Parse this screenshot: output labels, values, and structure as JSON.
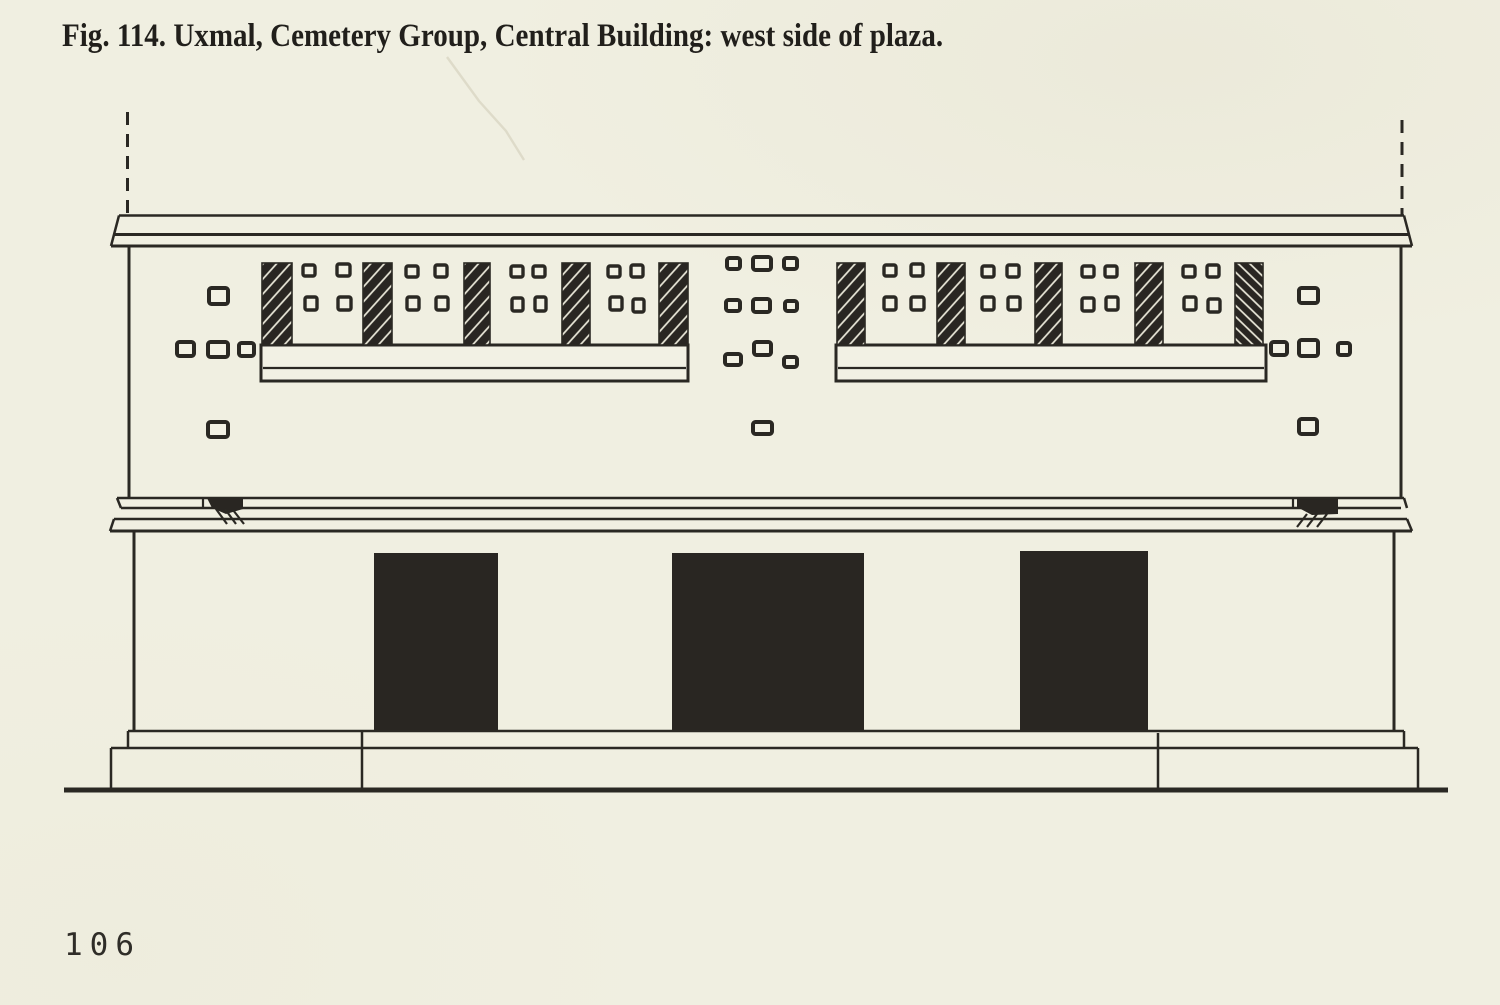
{
  "page": {
    "caption": "Fig. 114. Uxmal, Cemetery Group, Central Building: west side of plaza.",
    "page_number": "106"
  },
  "colors": {
    "paper": "#f0efe1",
    "paper2": "#f2f1e4",
    "ink": "#2a2823",
    "dark": "#292622"
  },
  "figure": {
    "description": "Line-drawing elevation: upper frieze with two lattice roof-comb panels of hatched uprights and small stones, medial molding with two damaged spots, lower wall with three dark doorways on a stepped platform",
    "lattice_bars": [
      {
        "x": 262,
        "y": 263,
        "w": 30,
        "h": 82,
        "hatch": "fwd"
      },
      {
        "x": 363,
        "y": 263,
        "w": 29,
        "h": 82,
        "hatch": "fwd"
      },
      {
        "x": 464,
        "y": 263,
        "w": 26,
        "h": 82,
        "hatch": "fwd"
      },
      {
        "x": 562,
        "y": 263,
        "w": 28,
        "h": 82,
        "hatch": "fwd"
      },
      {
        "x": 659,
        "y": 263,
        "w": 29,
        "h": 82,
        "hatch": "fwd"
      },
      {
        "x": 837,
        "y": 263,
        "w": 28,
        "h": 82,
        "hatch": "fwd"
      },
      {
        "x": 937,
        "y": 263,
        "w": 28,
        "h": 82,
        "hatch": "fwd"
      },
      {
        "x": 1035,
        "y": 263,
        "w": 27,
        "h": 82,
        "hatch": "fwd"
      },
      {
        "x": 1135,
        "y": 263,
        "w": 28,
        "h": 82,
        "hatch": "fwd"
      },
      {
        "x": 1235,
        "y": 263,
        "w": 28,
        "h": 82,
        "hatch": "back"
      }
    ],
    "shelves": [
      {
        "x": 261,
        "y": 345,
        "w": 427,
        "h": 36,
        "divider": 23
      },
      {
        "x": 836,
        "y": 345,
        "w": 430,
        "h": 36,
        "divider": 23
      }
    ],
    "gap_stones": [
      {
        "x": 303,
        "y": 265,
        "w": 12,
        "h": 11
      },
      {
        "x": 337,
        "y": 264,
        "w": 13,
        "h": 12
      },
      {
        "x": 305,
        "y": 297,
        "w": 12,
        "h": 13
      },
      {
        "x": 338,
        "y": 297,
        "w": 13,
        "h": 13
      },
      {
        "x": 406,
        "y": 266,
        "w": 12,
        "h": 11
      },
      {
        "x": 435,
        "y": 265,
        "w": 12,
        "h": 12
      },
      {
        "x": 407,
        "y": 297,
        "w": 12,
        "h": 13
      },
      {
        "x": 436,
        "y": 297,
        "w": 12,
        "h": 13
      },
      {
        "x": 511,
        "y": 266,
        "w": 12,
        "h": 11
      },
      {
        "x": 533,
        "y": 266,
        "w": 12,
        "h": 11
      },
      {
        "x": 512,
        "y": 298,
        "w": 11,
        "h": 13
      },
      {
        "x": 535,
        "y": 297,
        "w": 11,
        "h": 14
      },
      {
        "x": 608,
        "y": 266,
        "w": 12,
        "h": 11
      },
      {
        "x": 631,
        "y": 265,
        "w": 12,
        "h": 12
      },
      {
        "x": 610,
        "y": 297,
        "w": 12,
        "h": 13
      },
      {
        "x": 633,
        "y": 299,
        "w": 11,
        "h": 13
      },
      {
        "x": 884,
        "y": 265,
        "w": 12,
        "h": 11
      },
      {
        "x": 911,
        "y": 264,
        "w": 12,
        "h": 12
      },
      {
        "x": 884,
        "y": 297,
        "w": 12,
        "h": 13
      },
      {
        "x": 911,
        "y": 297,
        "w": 13,
        "h": 13
      },
      {
        "x": 982,
        "y": 266,
        "w": 12,
        "h": 11
      },
      {
        "x": 1007,
        "y": 265,
        "w": 12,
        "h": 12
      },
      {
        "x": 982,
        "y": 297,
        "w": 12,
        "h": 13
      },
      {
        "x": 1008,
        "y": 297,
        "w": 12,
        "h": 13
      },
      {
        "x": 1082,
        "y": 266,
        "w": 12,
        "h": 11
      },
      {
        "x": 1105,
        "y": 266,
        "w": 12,
        "h": 11
      },
      {
        "x": 1082,
        "y": 298,
        "w": 12,
        "h": 13
      },
      {
        "x": 1106,
        "y": 297,
        "w": 12,
        "h": 13
      },
      {
        "x": 1183,
        "y": 266,
        "w": 12,
        "h": 11
      },
      {
        "x": 1207,
        "y": 265,
        "w": 12,
        "h": 12
      },
      {
        "x": 1184,
        "y": 297,
        "w": 12,
        "h": 13
      },
      {
        "x": 1208,
        "y": 299,
        "w": 12,
        "h": 13
      }
    ],
    "scattered_stones": [
      {
        "x": 209,
        "y": 288,
        "w": 19,
        "h": 16
      },
      {
        "x": 177,
        "y": 342,
        "w": 17,
        "h": 14
      },
      {
        "x": 208,
        "y": 342,
        "w": 20,
        "h": 15
      },
      {
        "x": 239,
        "y": 343,
        "w": 15,
        "h": 13
      },
      {
        "x": 208,
        "y": 422,
        "w": 20,
        "h": 15
      },
      {
        "x": 727,
        "y": 258,
        "w": 13,
        "h": 11
      },
      {
        "x": 753,
        "y": 257,
        "w": 18,
        "h": 13
      },
      {
        "x": 784,
        "y": 258,
        "w": 13,
        "h": 11
      },
      {
        "x": 726,
        "y": 300,
        "w": 14,
        "h": 11
      },
      {
        "x": 753,
        "y": 299,
        "w": 17,
        "h": 13
      },
      {
        "x": 785,
        "y": 301,
        "w": 12,
        "h": 10
      },
      {
        "x": 725,
        "y": 354,
        "w": 16,
        "h": 11
      },
      {
        "x": 754,
        "y": 342,
        "w": 17,
        "h": 13
      },
      {
        "x": 784,
        "y": 357,
        "w": 13,
        "h": 10
      },
      {
        "x": 753,
        "y": 422,
        "w": 19,
        "h": 12
      },
      {
        "x": 1299,
        "y": 288,
        "w": 19,
        "h": 15
      },
      {
        "x": 1271,
        "y": 342,
        "w": 16,
        "h": 13
      },
      {
        "x": 1299,
        "y": 340,
        "w": 19,
        "h": 16
      },
      {
        "x": 1338,
        "y": 343,
        "w": 12,
        "h": 12
      },
      {
        "x": 1299,
        "y": 419,
        "w": 18,
        "h": 15
      }
    ],
    "doorways": [
      {
        "x": 374,
        "y": 553,
        "w": 124,
        "h": 178
      },
      {
        "x": 672,
        "y": 553,
        "w": 192,
        "h": 178
      },
      {
        "x": 1020,
        "y": 551,
        "w": 128,
        "h": 180
      }
    ]
  }
}
